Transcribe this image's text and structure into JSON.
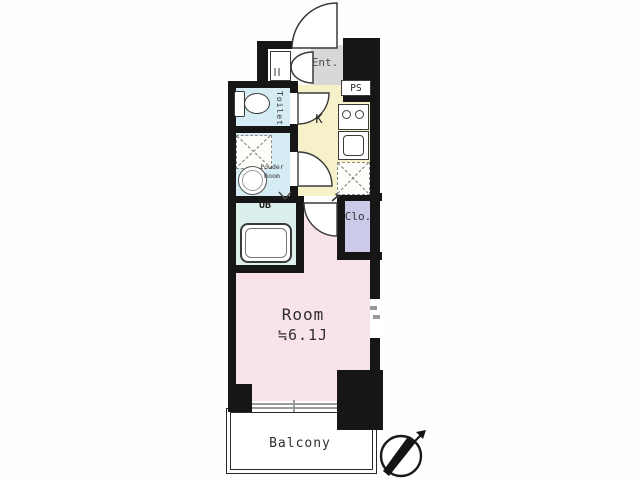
{
  "title": "1K apartment floor plan",
  "rooms": {
    "entrance": {
      "label": "Ent."
    },
    "pipe_space": {
      "label": "PS"
    },
    "kitchen": {
      "label": "K"
    },
    "toilet": {
      "label": "Toilet"
    },
    "powder_room": {
      "label": "Powder Room"
    },
    "unit_bath": {
      "label": "UB"
    },
    "closet": {
      "label": "Clo."
    },
    "main_room": {
      "name": "Room",
      "area": "≒6.1J"
    },
    "balcony": {
      "label": "Balcony"
    }
  },
  "icons": {
    "compass": "compass-needle-icon pointing northeast",
    "entrance_door": "quarter-circle door swing",
    "shoe_cabinet_door": "double-leaf door arcs",
    "washing_machine_space": "dashed box with X",
    "refrigerator_space": "dashed box with X"
  },
  "colors": {
    "wall": "#161616",
    "toilet_floor": "#d6ecf5",
    "powder_floor": "#d6ecf5",
    "bath_floor": "#dcefec",
    "kitchen_floor": "#f6f1c8",
    "entrance_floor": "#d8d8d8",
    "closet_floor": "#cbcbe9",
    "room_floor": "#f9e3ea",
    "balcony_floor": "#ffffff"
  }
}
